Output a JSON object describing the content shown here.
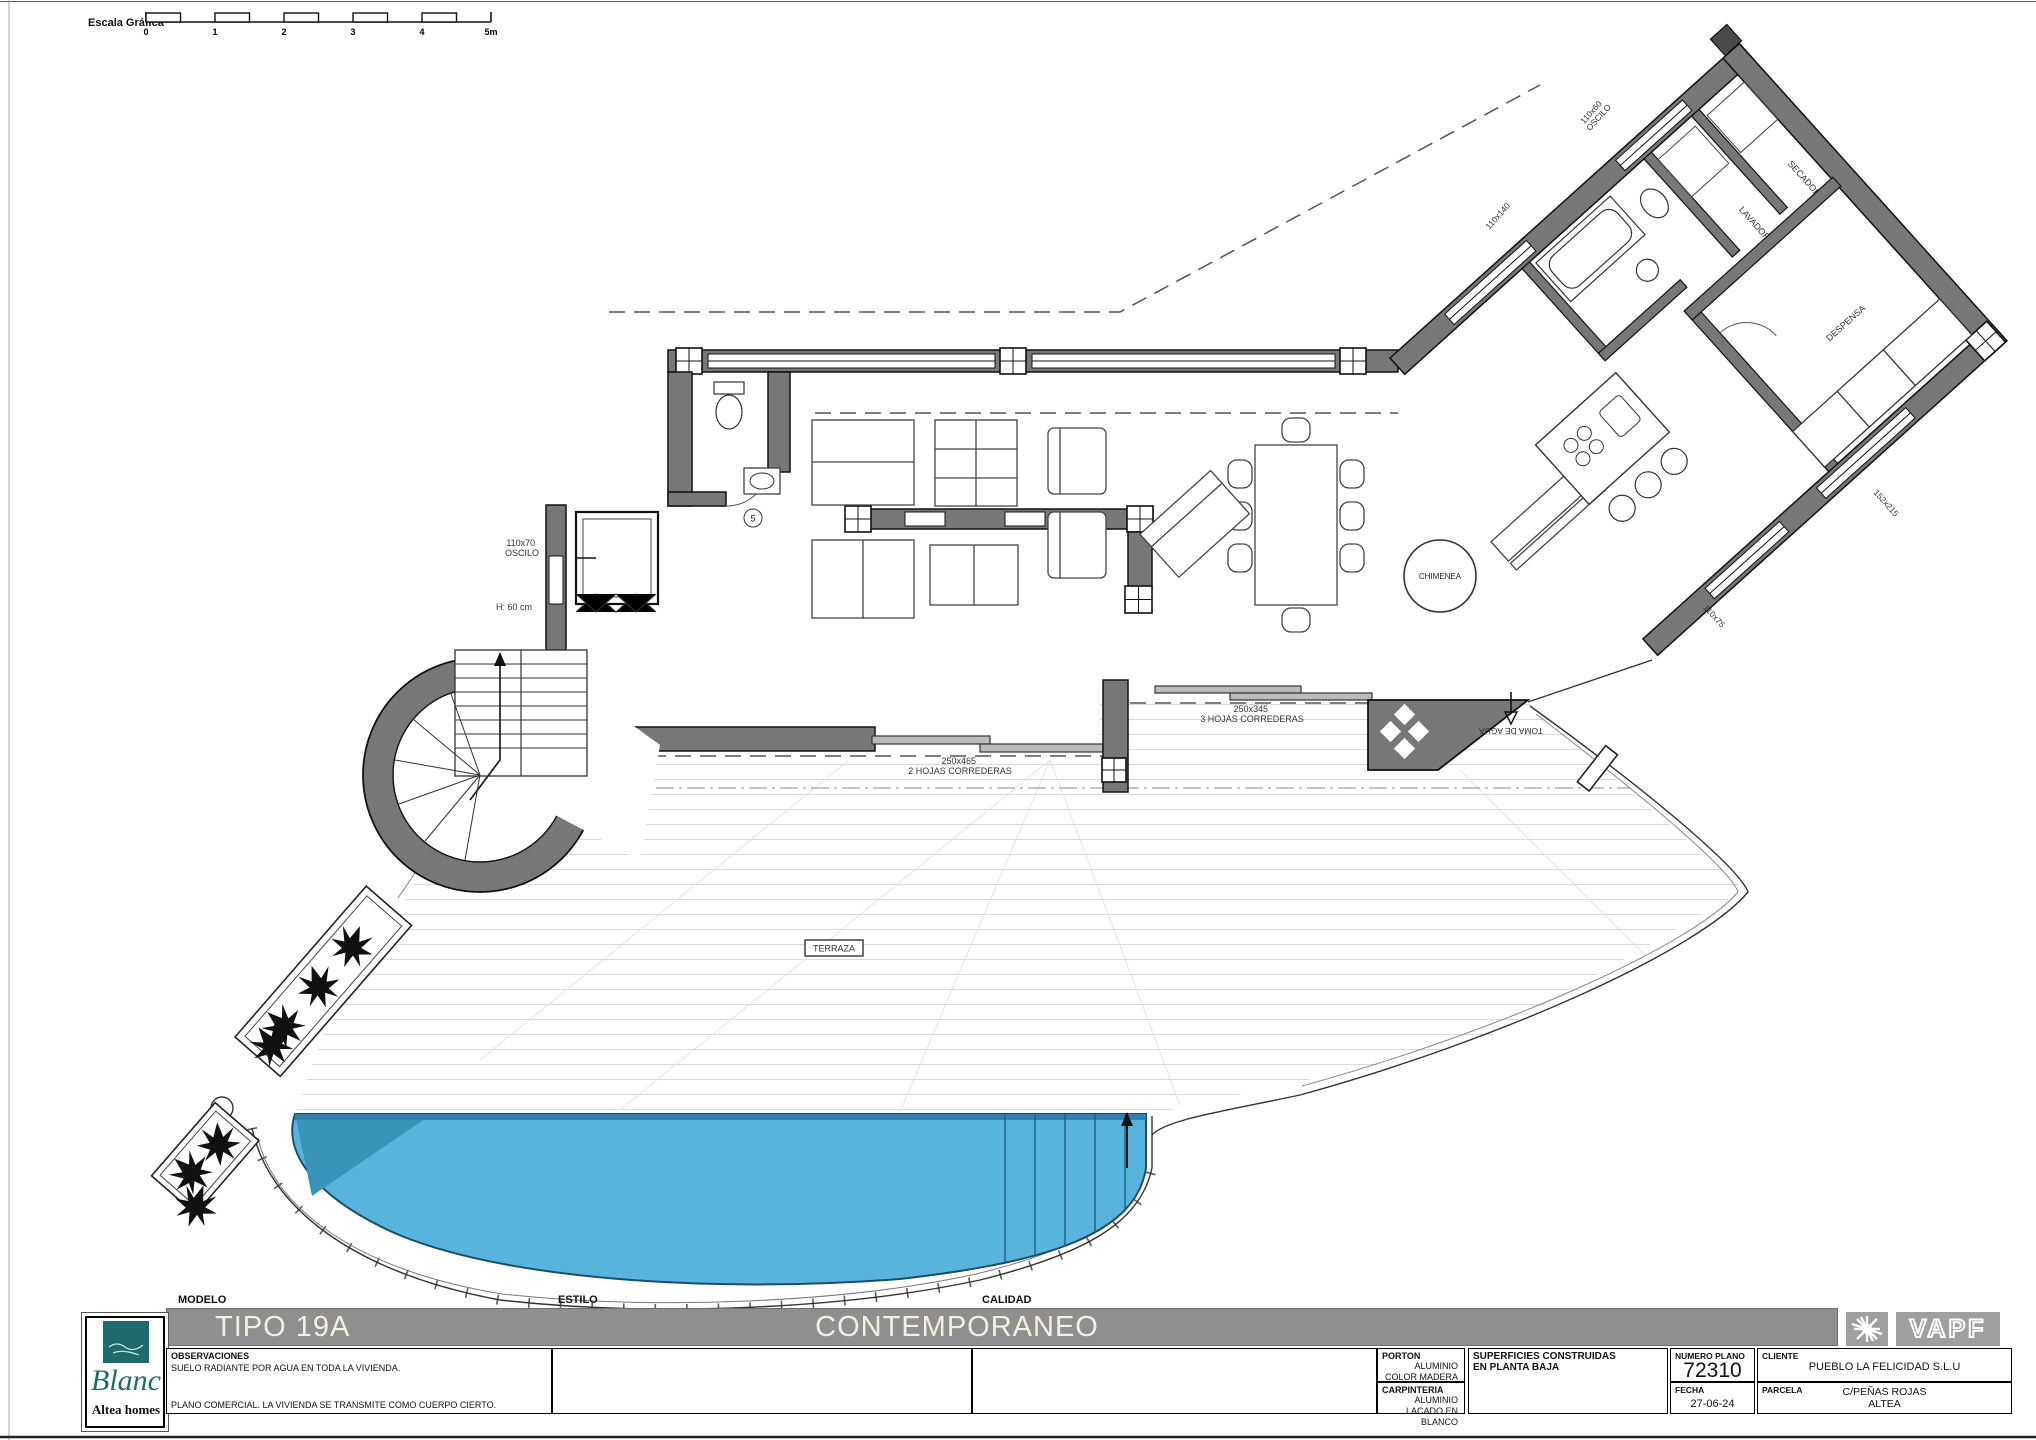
{
  "scale_bar": {
    "label": "Escala Gráfica",
    "ticks": [
      "0",
      "1",
      "2",
      "3",
      "4",
      "5m"
    ]
  },
  "plan": {
    "terraza": "TERRAZA",
    "chimenea": "CHIMENEA",
    "despensa": "DESPENSA",
    "lavadora": "LAVADORA",
    "secadora": "SECADORA",
    "toma_agua": "TOMA DE AGUA",
    "win_left_size": "110x70",
    "win_left_type": "OSCILO",
    "wall_h": "H: 60 cm",
    "win_top_size": "110x60",
    "win_top_type": "OSCILO",
    "door3_size": "250x345",
    "door3_type": "3 HOJAS CORREDERAS",
    "door2_size": "250x465",
    "door2_type": "2 HOJAS CORREDERAS",
    "win_right_a": "152x215",
    "win_right_b": "110x75",
    "win_wing": "110x140",
    "tag_5": "5"
  },
  "title_block": {
    "modelo_label": "MODELO",
    "modelo_value": "TIPO 19A",
    "estilo_label": "ESTILO",
    "estilo_value": "CONTEMPORANEO",
    "calidad_label": "CALIDAD",
    "observaciones_label": "OBSERVACIONES",
    "observaciones_line1": "SUELO RADIANTE POR AGUA EN TODA LA VIVIENDA.",
    "observaciones_line2": "PLANO COMERCIAL. LA VIVIENDA SE TRANSMITE COMO CUERPO CIERTO.",
    "porton_label": "PORTON",
    "porton_line1": "ALUMINIO",
    "porton_line2": "COLOR MADERA",
    "carpinteria_label": "CARPINTERIA",
    "carpinteria_line1": "ALUMINIO",
    "carpinteria_line2": "LACADO EN BLANCO",
    "superficies_label": "SUPERFICIES CONSTRUIDAS",
    "superficies_line2": "EN PLANTA BAJA",
    "numero_plano_label": "NUMERO PLANO",
    "numero_plano_value": "72310",
    "fecha_label": "FECHA",
    "fecha_value": "27-06-24",
    "cliente_label": "CLIENTE",
    "cliente_value": "PUEBLO LA FELICIDAD S.L.U",
    "parcela_label": "PARCELA",
    "parcela_line1": "C/PEÑAS ROJAS",
    "parcela_line2": "ALTEA"
  },
  "brand": {
    "name": "Blanc",
    "tagline": "Altea homes"
  },
  "vapf": {
    "name": "VAPF"
  }
}
